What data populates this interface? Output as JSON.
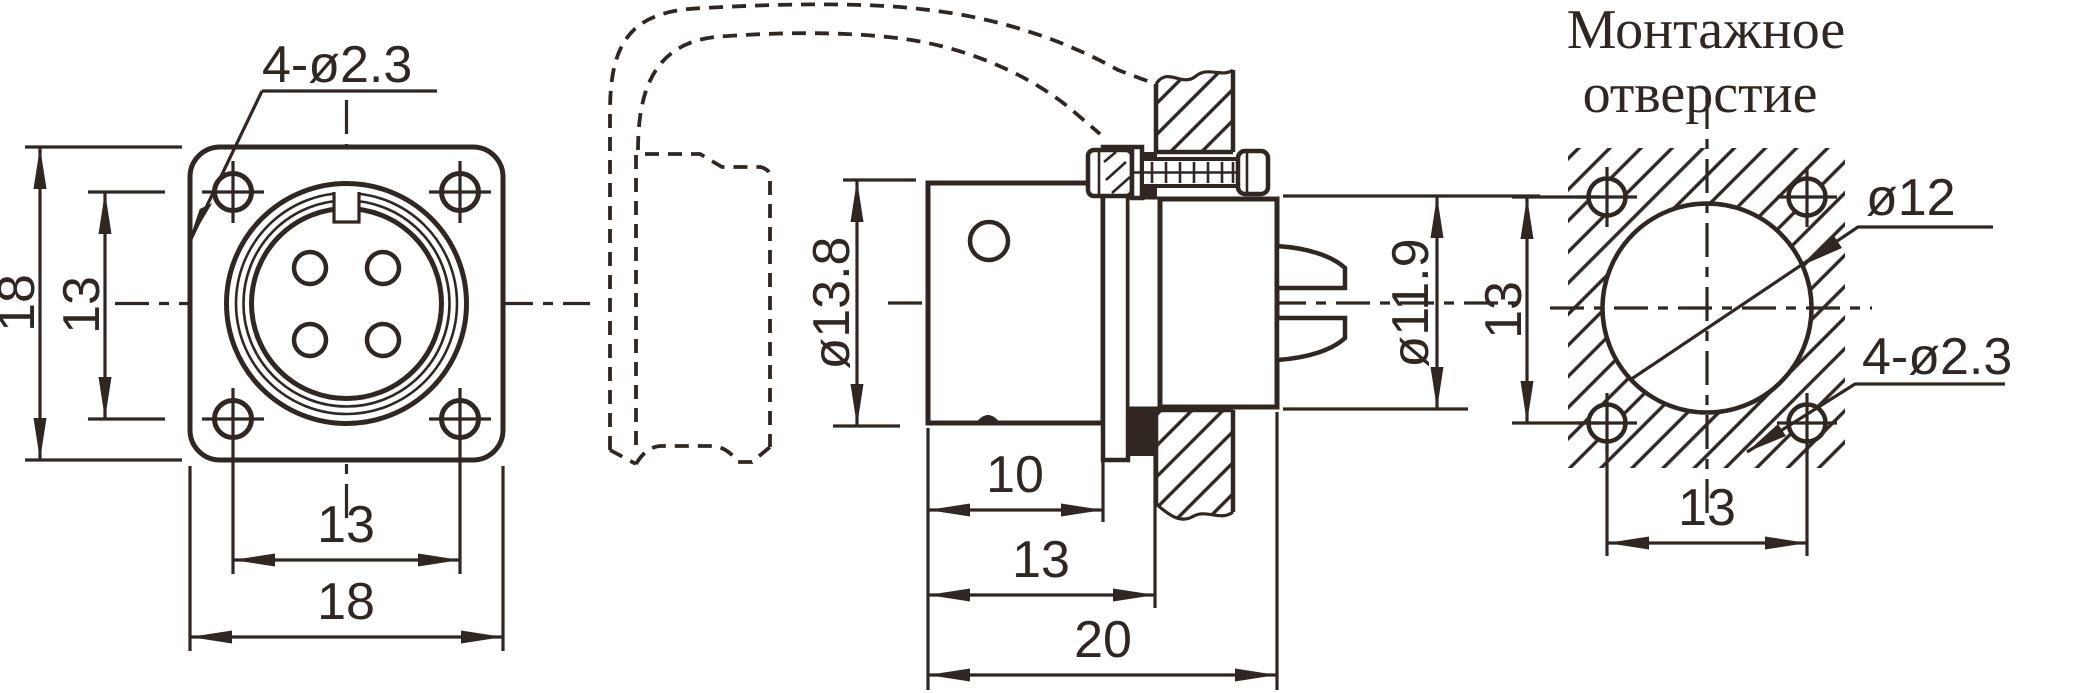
{
  "drawing": {
    "type": "connector-outline-drawing",
    "colors": {
      "ink": "#302722",
      "background": "#ffffff"
    },
    "front_view": {
      "flange_height": "18",
      "hole_spacing_vertical": "13",
      "hole_spacing_horizontal": "13",
      "flange_width": "18",
      "mounting_holes_label": "4-ø2.3"
    },
    "side_view": {
      "front_diameter": "ø13.8",
      "rear_diameter": "ø11.9",
      "front_length": "10",
      "length_to_panel": "13",
      "total_length": "20"
    },
    "mounting_view": {
      "title_line1": "Монтажное",
      "title_line2": "отверстие",
      "hole_spacing_vertical": "13",
      "hole_spacing_horizontal": "13",
      "panel_hole_diameter": "ø12",
      "corner_holes_label": "4-ø2.3"
    }
  }
}
